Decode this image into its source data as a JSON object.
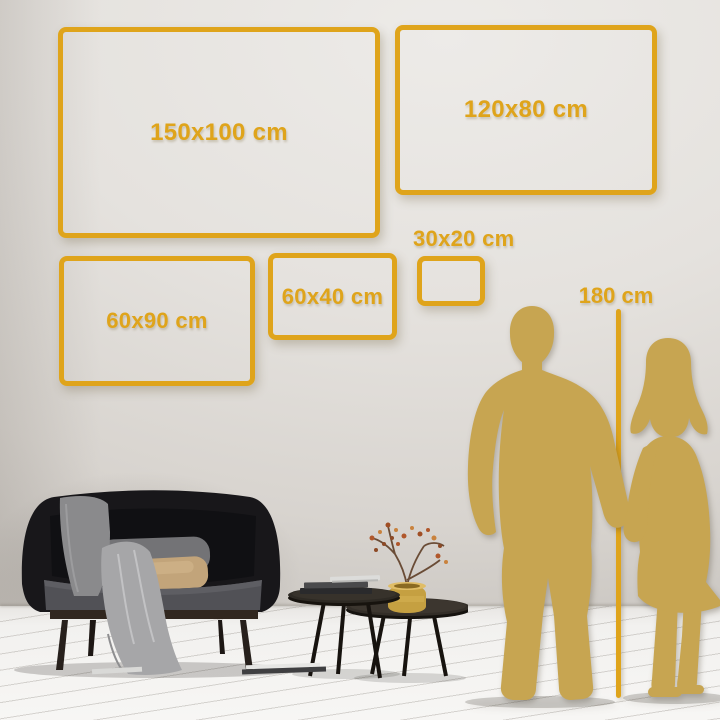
{
  "frames": [
    {
      "label": "150x100 cm",
      "width_cm": 150,
      "height_cm": 100
    },
    {
      "label": "120x80 cm",
      "width_cm": 120,
      "height_cm": 80
    },
    {
      "label": "60x90 cm",
      "width_cm": 60,
      "height_cm": 90
    },
    {
      "label": "60x40 cm",
      "width_cm": 60,
      "height_cm": 40
    },
    {
      "label": "30x20 cm",
      "width_cm": 30,
      "height_cm": 20
    }
  ],
  "height_marker": {
    "label": "180 cm",
    "height_cm": 180
  },
  "colors": {
    "gold_accent": "#DFA41B",
    "silhouette_gold": "#C7A551",
    "wall": "#E3E0DC",
    "floor": "#F4F3F1"
  },
  "scene": {
    "objects": [
      "sofa",
      "throw-blanket",
      "pillows",
      "nesting-coffee-tables",
      "books",
      "gold-vase-with-dried-branch",
      "man-silhouette",
      "woman-silhouette",
      "height-measure-line"
    ]
  }
}
